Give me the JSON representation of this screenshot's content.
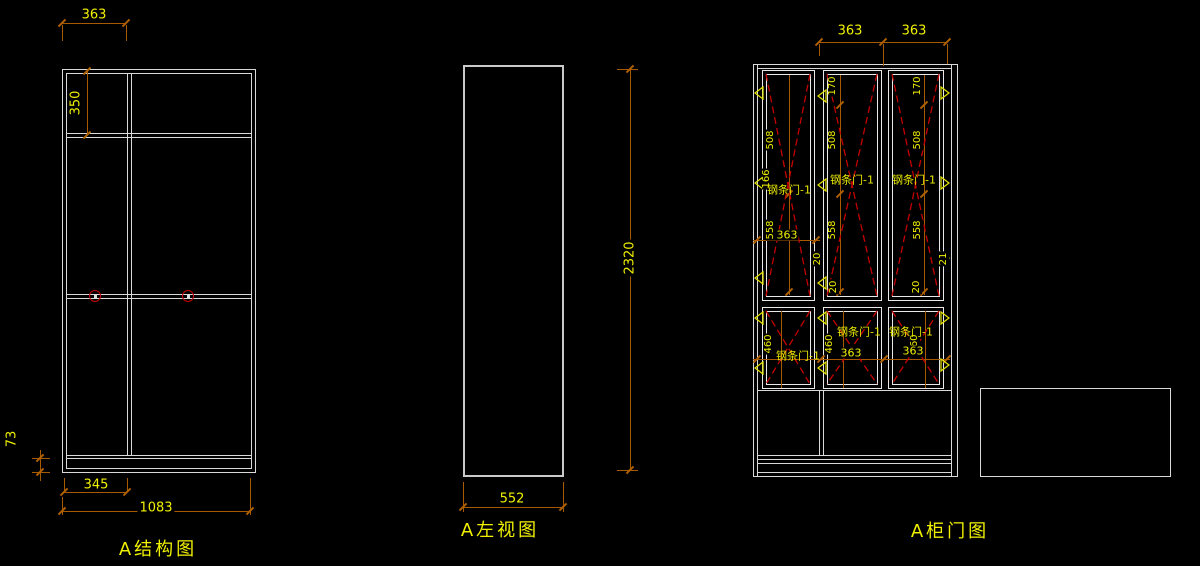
{
  "drawing": {
    "background": "#000000",
    "geometry_color": "#d9d9d9",
    "dimension_color": "#a85a00",
    "dimension_text_color": "#f0f000",
    "door_dashed_color": "#c40000",
    "connector_symbol_color": "#c40000"
  },
  "structure_view": {
    "title": "A结构图",
    "dim_top_width": "363",
    "dim_top_section_height": "350",
    "dim_base_height": "73",
    "dim_left_bay_width": "345",
    "dim_total_width": "1083"
  },
  "side_view": {
    "title": "A左视图",
    "dim_depth": "552",
    "dim_total_height": "2320"
  },
  "door_view": {
    "title": "A柜门图",
    "door_label": "钢条门-1",
    "dim_left_door_width": "363",
    "dim_right_door_width": "363",
    "dim_top_rail": "170",
    "dim_upper_panel_height": "508",
    "dim_lower_panel_height": "558",
    "dim_hinge_offset": "166",
    "dim_door_inner_width": "363",
    "dim_bottom_rail": "20",
    "dim_bottom_rail_alt": "21",
    "dim_small_door_height": "460",
    "dim_small_door_width": "363"
  }
}
